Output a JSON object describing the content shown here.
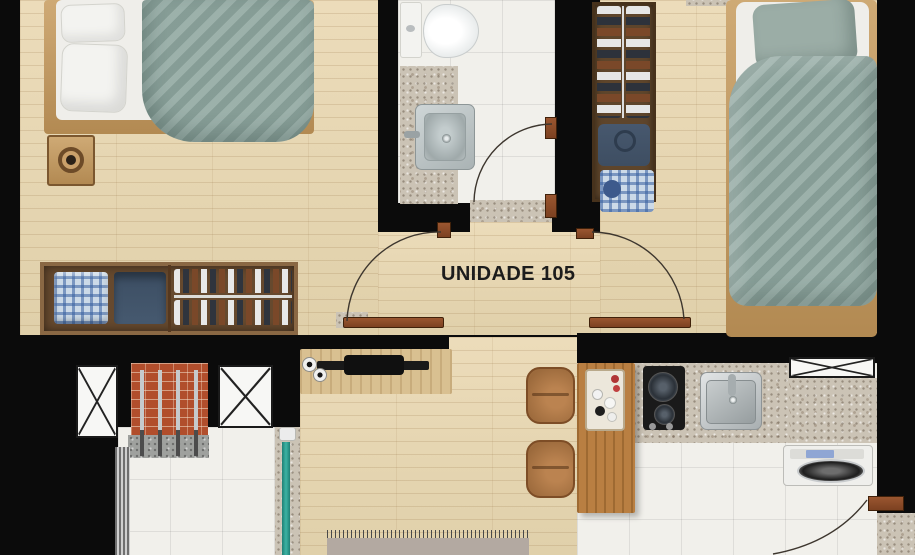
{
  "plan": {
    "unit_label": "UNIDADE 105"
  },
  "furniture": [
    "double-bed",
    "nightstand",
    "wardrobe",
    "toilet",
    "bathroom-vanity",
    "single-bed",
    "shoe-rack",
    "tv-console",
    "kitchen-island",
    "dining-chair",
    "cooktop",
    "kitchen-sink",
    "washing-machine",
    "barbecue-grill",
    "ventilation-shaft",
    "rug",
    "balcony-glass-door"
  ],
  "colors": {
    "wall": "#0b0b0b",
    "wood_floor": "#e6d6b2",
    "tile_floor": "#f1f0eb",
    "granite": "#cbc3b5",
    "bedding_teal": "#91a8a1",
    "furniture_wood": "#c89e62",
    "wardrobe_brown": "#7b5b3a",
    "door_brown": "#8a4a28",
    "glass_teal": "#2ea093",
    "brick": "#b14e2c"
  }
}
